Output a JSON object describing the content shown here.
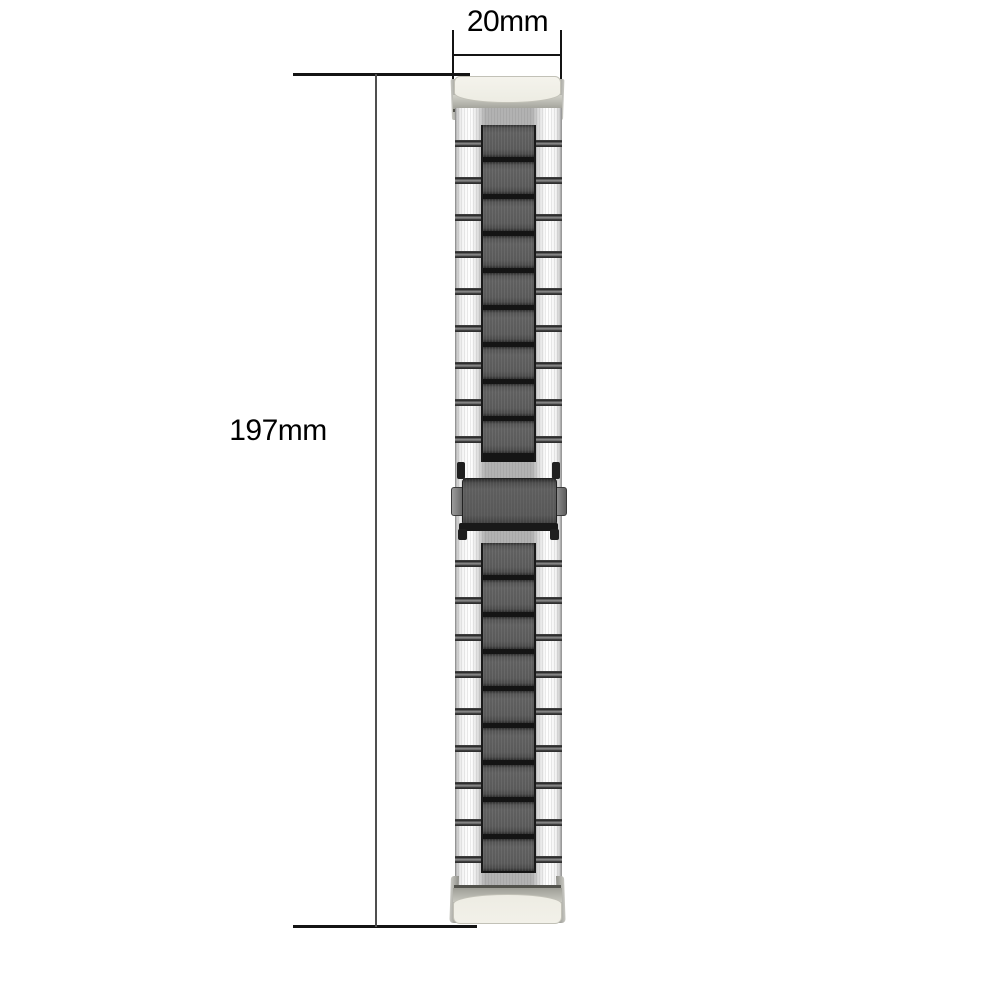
{
  "page": {
    "background": "#ffffff",
    "description": "Product dimension diagram of a two-tone stainless-steel watch band with fold-over clasp, shown vertically with width and length measurements"
  },
  "dimensions": {
    "width": {
      "label": "20mm"
    },
    "length": {
      "label": "197mm"
    }
  },
  "band": {
    "upper_link_rows": 9,
    "lower_link_rows": 9,
    "link_style": "three-column links: silver outer columns, dark gunmetal center column",
    "clasp": "center fold-over clasp with two side push buttons",
    "end_connectors": "ivory end links at both ends"
  },
  "colors": {
    "background": "#ffffff",
    "dimension_line": "#141414",
    "dimension_vertical_line": "#4f4f4f",
    "dimension_text": "#000000",
    "silver_link_highlight": "#fbfbfb",
    "dark_link": "#565656",
    "link_gap_black": "#141414",
    "connector_ivory": "#edece3",
    "connector_border": "#c2c1b7",
    "metal_gray_band": "#a8a8a0",
    "dark_metal_line": "#53534d"
  }
}
